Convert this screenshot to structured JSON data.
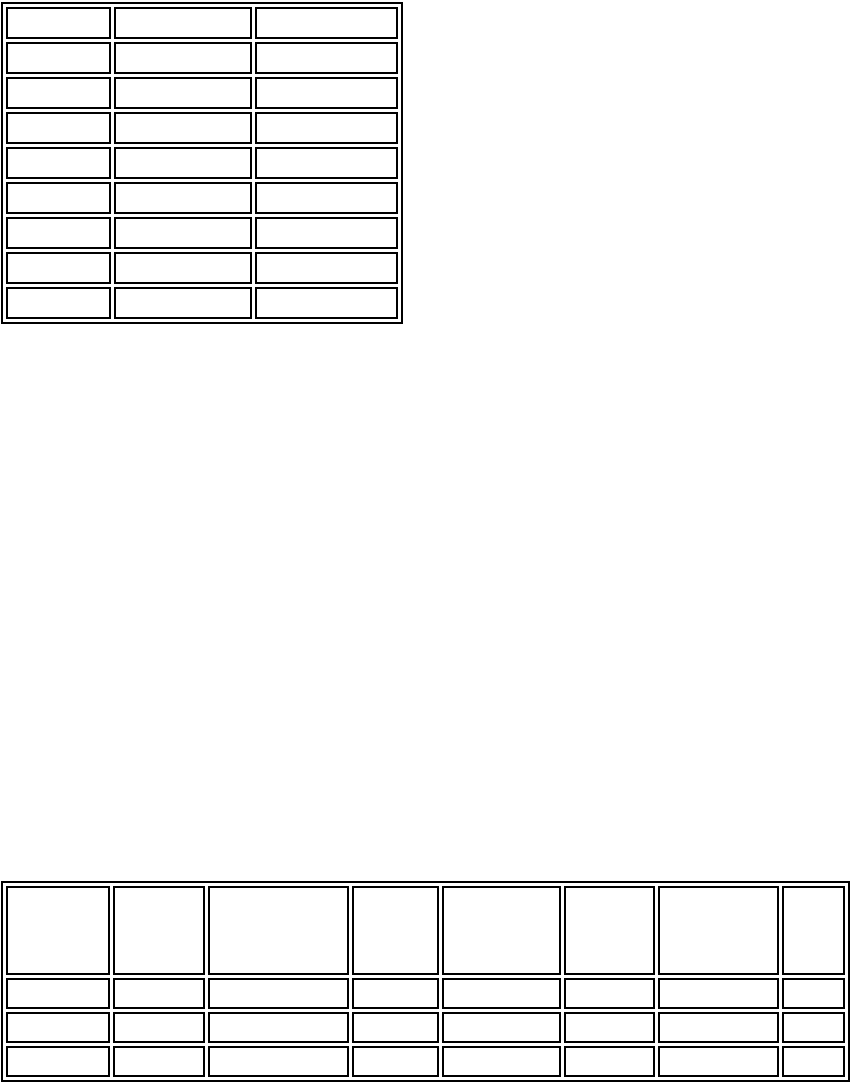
{
  "colors": {
    "page_background": "#ffffff",
    "table_border": "#000000"
  },
  "tables": [
    {
      "name": "top-left-table",
      "columns": 3,
      "row_count": 9,
      "rows": [
        [
          "",
          "",
          ""
        ],
        [
          "",
          "",
          ""
        ],
        [
          "",
          "",
          ""
        ],
        [
          "",
          "",
          ""
        ],
        [
          "",
          "",
          ""
        ],
        [
          "",
          "",
          ""
        ],
        [
          "",
          "",
          ""
        ],
        [
          "",
          "",
          ""
        ],
        [
          "",
          "",
          ""
        ]
      ]
    },
    {
      "name": "bottom-full-width-table",
      "columns": 8,
      "row_count": 4,
      "rows": [
        [
          "",
          "",
          "",
          "",
          "",
          "",
          "",
          ""
        ],
        [
          "",
          "",
          "",
          "",
          "",
          "",
          "",
          ""
        ],
        [
          "",
          "",
          "",
          "",
          "",
          "",
          "",
          ""
        ],
        [
          "",
          "",
          "",
          "",
          "",
          "",
          "",
          ""
        ]
      ]
    }
  ]
}
